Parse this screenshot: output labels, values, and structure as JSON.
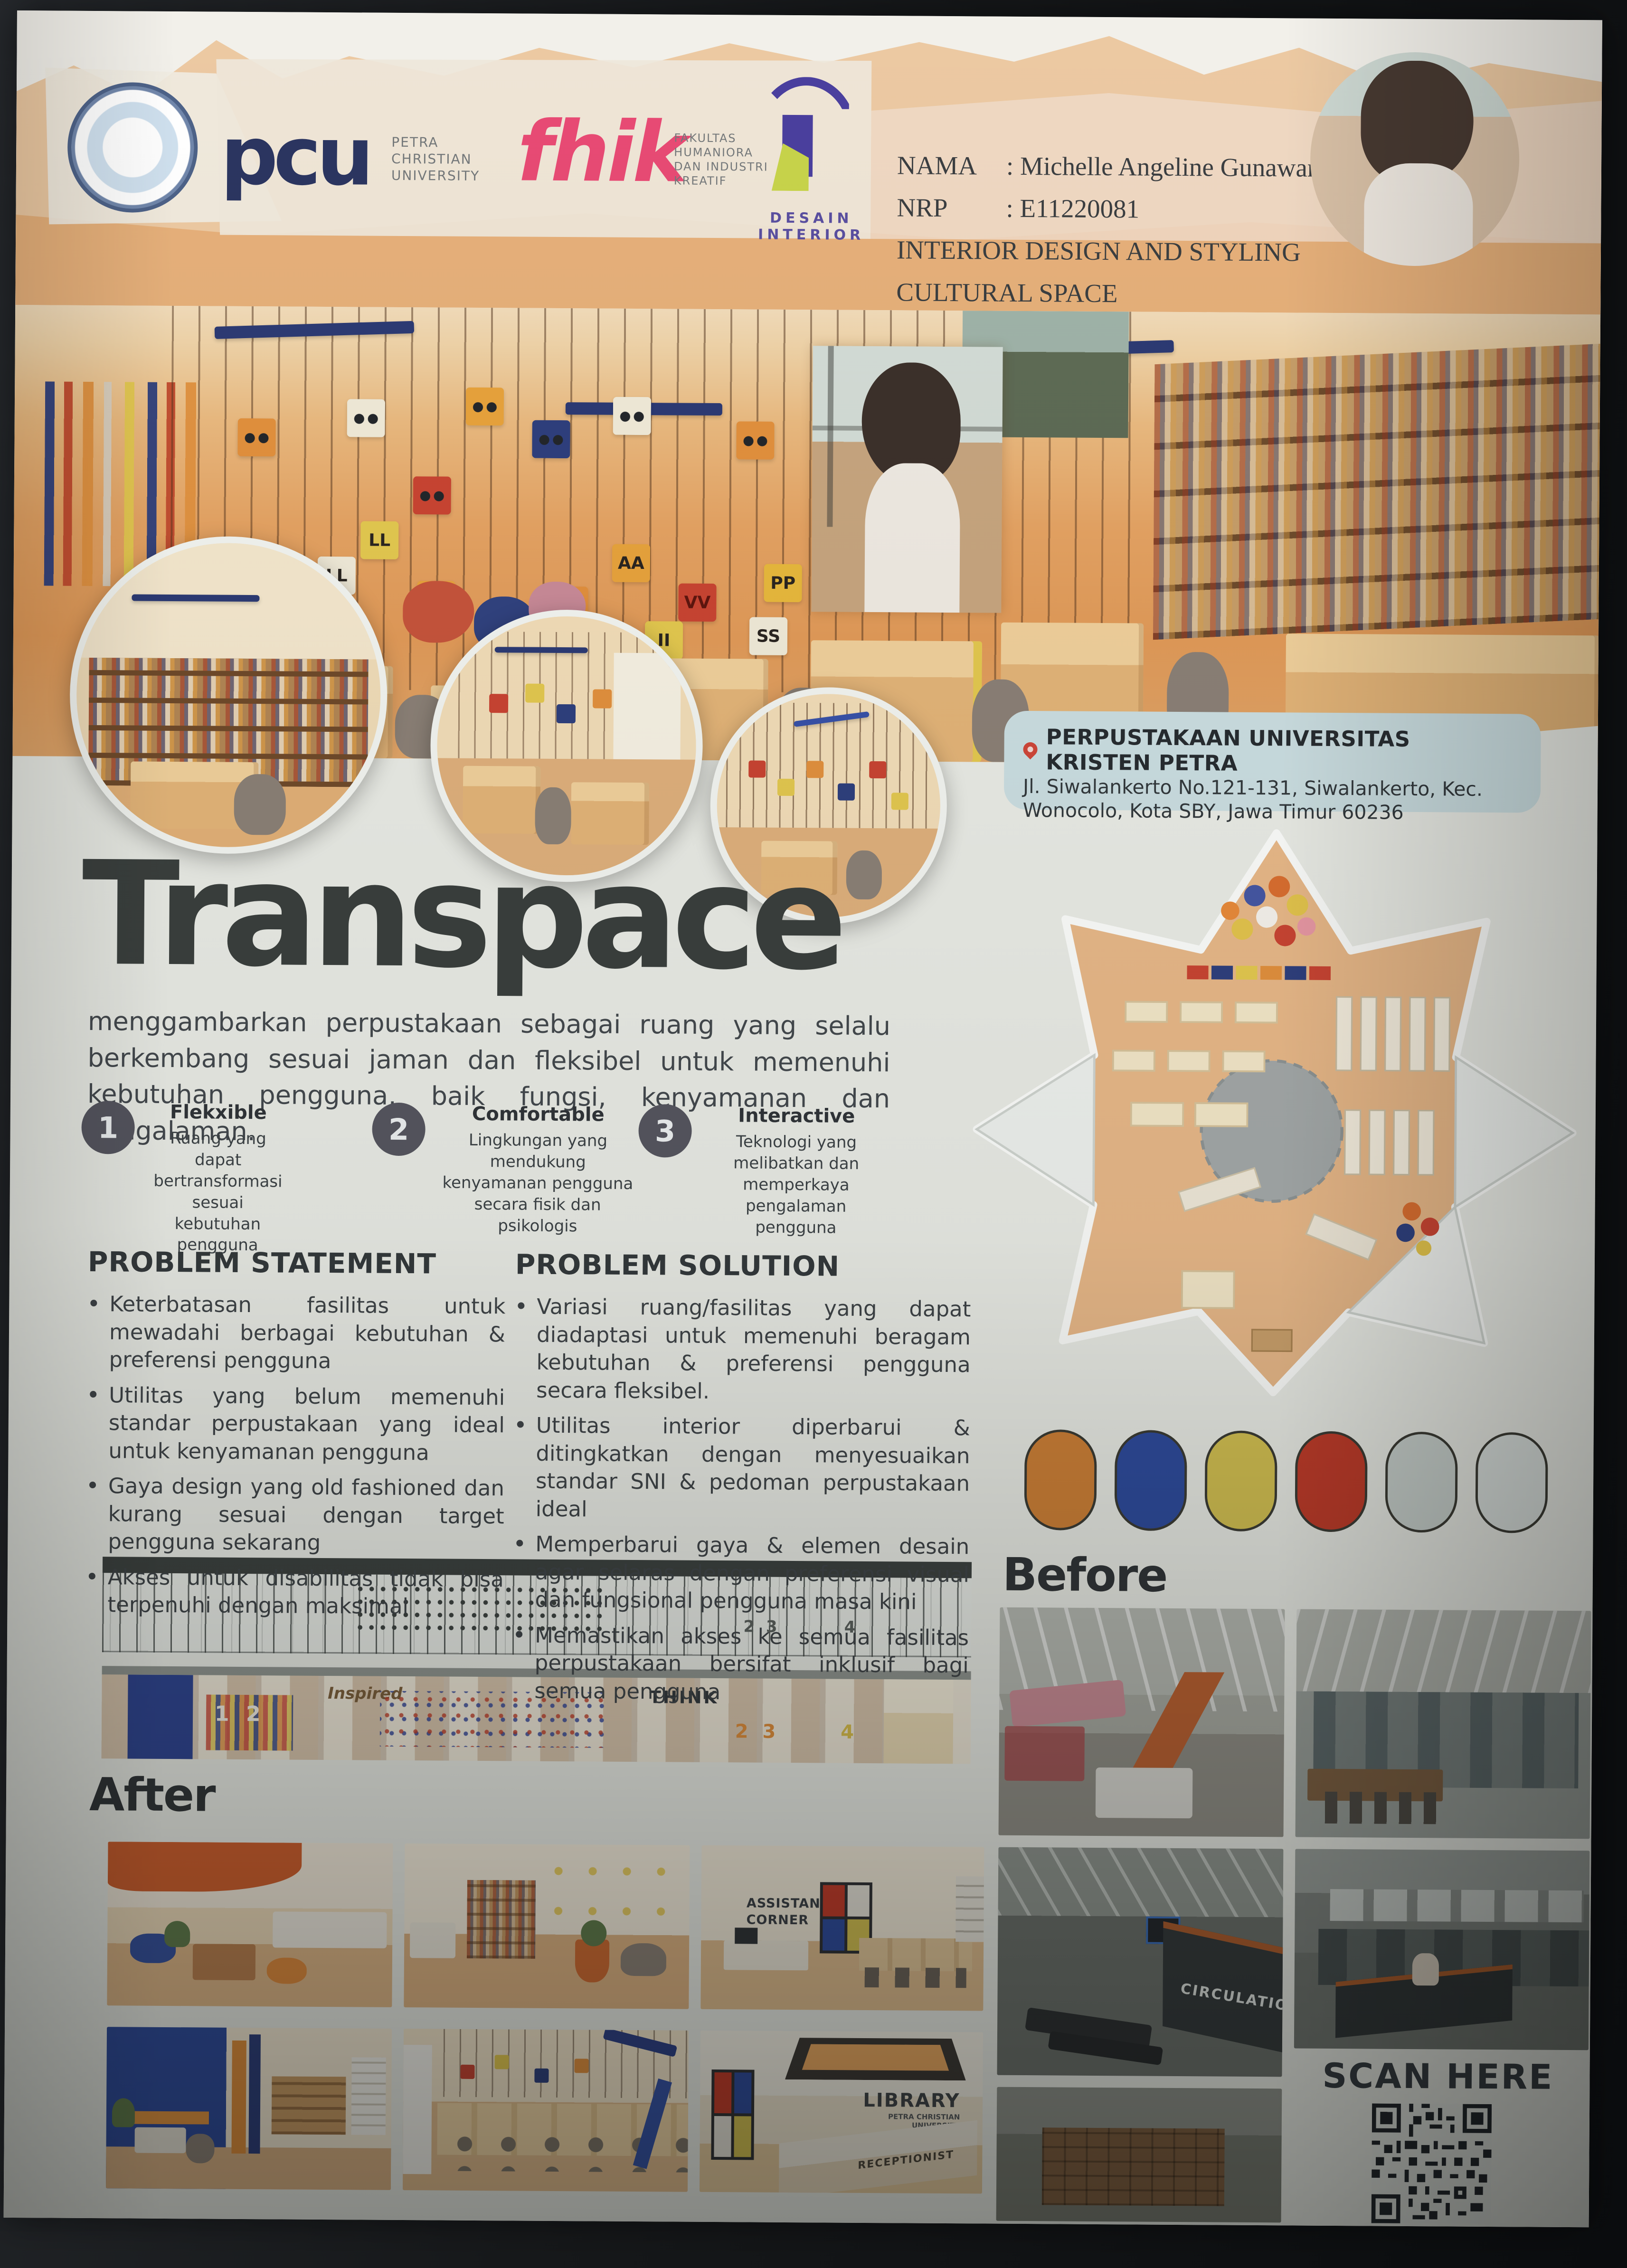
{
  "poster": {
    "header": {
      "id_block": {
        "nama_label": "NAMA",
        "nama_value": ": Michelle Angeline Gunawan",
        "nrp_label": "NRP",
        "nrp_value": ": E11220081",
        "program": "INTERIOR DESIGN AND STYLING",
        "topic": "CULTURAL SPACE"
      },
      "logos": {
        "pcu_acronym": "pcu",
        "pcu_lines": [
          "PETRA",
          "CHRISTIAN",
          "UNIVERSITY"
        ],
        "fhik_acronym": "fhik",
        "fhik_lines": [
          "FAKULTAS",
          "HUMANIORA",
          "DAN INDUSTRI",
          "KREATIF"
        ],
        "desain_lines": [
          "DESAIN",
          "INTERIOR"
        ]
      }
    },
    "location": {
      "title": "PERPUSTAKAAN UNIVERSITAS KRISTEN PETRA",
      "address_line1": "Jl. Siwalankerto No.121-131, Siwalankerto, Kec.",
      "address_line2": "Wonocolo, Kota SBY, Jawa Timur 60236"
    },
    "title": "Transpace",
    "description": "menggambarkan perpustakaan sebagai ruang yang selalu berkembang sesuai jaman dan fleksibel untuk memenuhi kebutuhan pengguna, baik fungsi, kenyamanan dan pengalaman.",
    "features": [
      {
        "number": "1",
        "title": "Flekxible",
        "desc": "Ruang yang dapat bertransformasi sesuai kebutuhan pengguna"
      },
      {
        "number": "2",
        "title": "Comfortable",
        "desc": "Lingkungan yang mendukung kenyamanan pengguna secara fisik dan psikologis"
      },
      {
        "number": "3",
        "title": "Interactive",
        "desc": "Teknologi yang melibatkan dan memperkaya pengalaman pengguna"
      }
    ],
    "problem_statement": {
      "heading": "PROBLEM STATEMENT",
      "items": [
        "Keterbatasan fasilitas untuk mewadahi berbagai kebutuhan & preferensi pengguna",
        "Utilitas yang belum memenuhi standar perpustakaan yang ideal untuk kenyamanan pengguna",
        "Gaya design yang old fashioned dan kurang sesuai dengan target pengguna sekarang",
        "Akses untuk disabilitas tidak bisa terpenuhi dengan maksimal"
      ]
    },
    "problem_solution": {
      "heading": "PROBLEM SOLUTION",
      "items": [
        "Variasi ruang/fasilitas yang dapat diadaptasi untuk memenuhi beragam kebutuhan & preferensi pengguna secara fleksibel.",
        "Utilitas interior diperbarui & ditingkatkan dengan menyesuaikan standar SNI & pedoman perpustakaan ideal",
        "Memperbarui gaya & elemen desain agar selaras dengan preferensi visual dan fungsional pengguna masa kini",
        "Memastikan akses ke semua fasilitas perpustakaan bersifat inklusif bagi semua pengguna"
      ]
    },
    "palette": [
      "#cd7f35",
      "#2d4a9c",
      "#d2bf50",
      "#bf3a28",
      "#c9d1cd",
      "#dbe1de"
    ],
    "sections": {
      "before": "Before",
      "after": "After",
      "scan": "SCAN HERE"
    },
    "hero": {
      "letter_blocks": [
        "CC",
        "LL",
        "LL",
        "AA",
        "AA",
        "OO",
        "AA",
        "VV",
        "II",
        "PP",
        "SS"
      ]
    },
    "labels": {
      "circulation": "CIRCULATION",
      "assistant_corner": "ASSISTANT CORNER",
      "library": "LIBRARY",
      "library_sub": "PETRA CHRISTIAN UNIVERSITY",
      "receptionist": "RECEPTIONIST",
      "inspired": "Inspired",
      "think": "THINK",
      "nums_a": "1 2",
      "nums_b": "2 3",
      "nums_c": "4"
    }
  }
}
